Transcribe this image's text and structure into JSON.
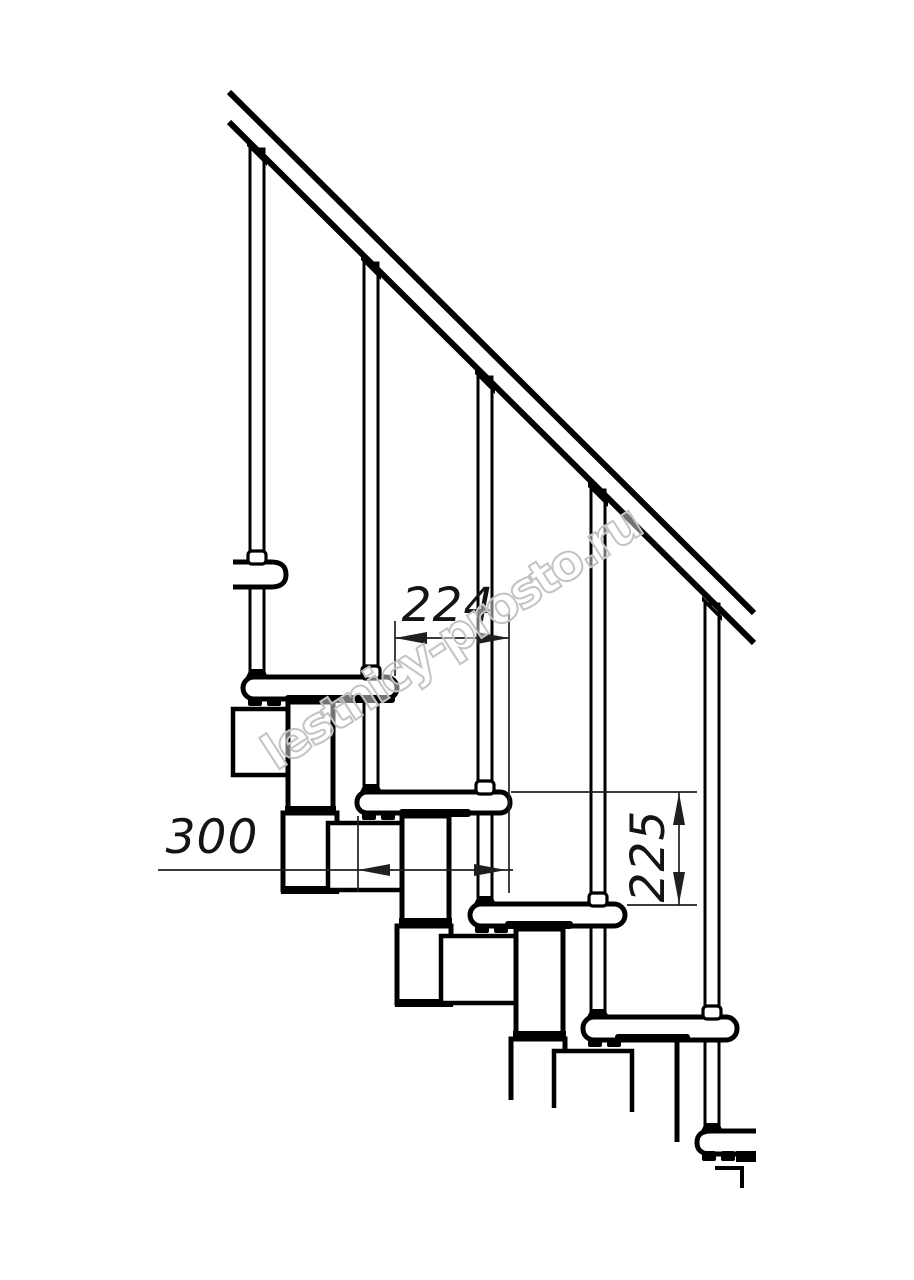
{
  "drawing": {
    "description": "Technical side-view drawing of a modular staircase with handrail and balusters",
    "watermark": "lestnicy-prosto.ru",
    "dimensions": {
      "tread_run": "224",
      "tread_depth": "300",
      "step_height": "225"
    },
    "colors": {
      "line": "#000000",
      "dimension_line": "#1f1f1f",
      "watermark_outline": "#c3c3c3",
      "background": "#ffffff"
    }
  }
}
